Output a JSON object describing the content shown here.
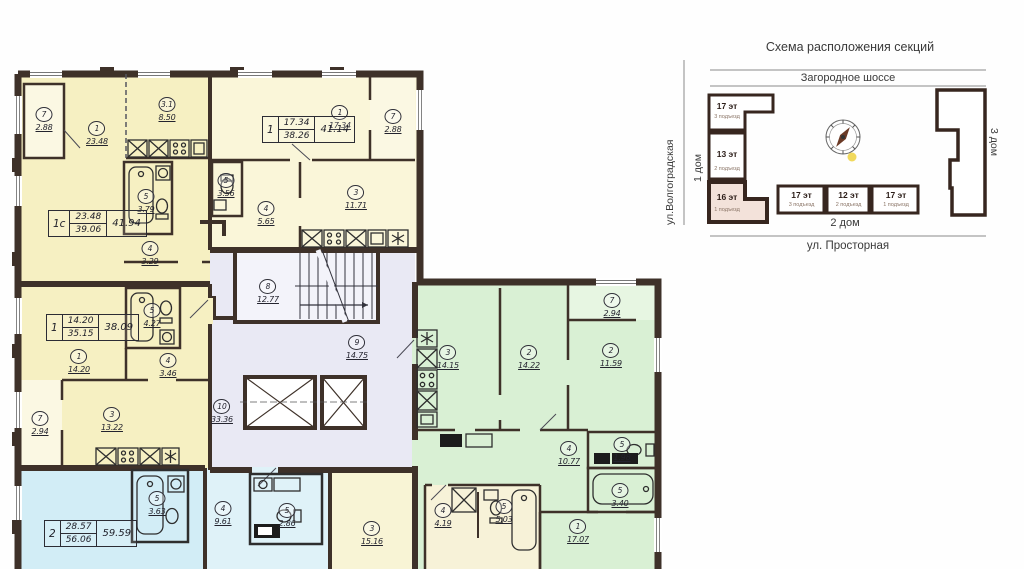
{
  "plan": {
    "rooms": [
      {
        "num": "7",
        "area": "2.88"
      },
      {
        "num": "1",
        "area": "23.48"
      },
      {
        "num": "3.1",
        "area": "8.50"
      },
      {
        "num": "5",
        "area": "3.79"
      },
      {
        "num": "4",
        "area": "3.29"
      },
      {
        "num": "5",
        "area": "3.56"
      },
      {
        "num": "1",
        "area": "17.34"
      },
      {
        "num": "7",
        "area": "2.88"
      },
      {
        "num": "3",
        "area": "11.71"
      },
      {
        "num": "4",
        "area": "5.65"
      },
      {
        "num": "1",
        "area": "14.20"
      },
      {
        "num": "5",
        "area": "4.27"
      },
      {
        "num": "4",
        "area": "3.46"
      },
      {
        "num": "3",
        "area": "13.22"
      },
      {
        "num": "7",
        "area": "2.94"
      },
      {
        "num": "8",
        "area": "12.77"
      },
      {
        "num": "9",
        "area": "14.75"
      },
      {
        "num": "10",
        "area": "33.36"
      },
      {
        "num": "3",
        "area": "14.15"
      },
      {
        "num": "2",
        "area": "14.22"
      },
      {
        "num": "2",
        "area": "11.59"
      },
      {
        "num": "7",
        "area": "2.94"
      },
      {
        "num": "4",
        "area": "10.77"
      },
      {
        "num": "5",
        "area": "1.98"
      },
      {
        "num": "5",
        "area": "3.40"
      },
      {
        "num": "1",
        "area": "17.07"
      },
      {
        "num": "5",
        "area": "3.63"
      },
      {
        "num": "4",
        "area": "9.61"
      },
      {
        "num": "5",
        "area": "2.86"
      },
      {
        "num": "3",
        "area": "15.16"
      },
      {
        "num": "4",
        "area": "4.19"
      },
      {
        "num": "5",
        "area": "5.03"
      }
    ],
    "stamps": [
      {
        "type": "1с",
        "living": "23.48",
        "area": "39.06",
        "total": "41.94"
      },
      {
        "type": "1",
        "living": "17.34",
        "area": "38.26",
        "total": "41.14"
      },
      {
        "type": "1",
        "living": "14.20",
        "area": "35.15",
        "total": "38.09"
      },
      {
        "type": "2",
        "living": "28.57",
        "area": "56.06",
        "total": "59.59"
      }
    ]
  },
  "scheme": {
    "title": "Схема расположения секций",
    "road_top": "Загородное шоссе",
    "street_left": "ул.Волгоградская",
    "street_bottom": "ул. Просторная",
    "house1": "1 дом",
    "house2": "2 дом",
    "house3": "3 дом",
    "left_sections": [
      {
        "floors": "17 эт",
        "entrance": "3 подъезд"
      },
      {
        "floors": "13 эт",
        "entrance": "2 подъезд"
      },
      {
        "floors": "16 эт",
        "entrance": "1 подъезд"
      }
    ],
    "bottom_sections": [
      {
        "floors": "17 эт",
        "entrance": "3 подъезд"
      },
      {
        "floors": "12 эт",
        "entrance": "2 подъезд"
      },
      {
        "floors": "17 эт",
        "entrance": "1 подъезд"
      }
    ],
    "colors": {
      "highlight_section": "#f3e2da",
      "wall": "#3e3129"
    }
  }
}
